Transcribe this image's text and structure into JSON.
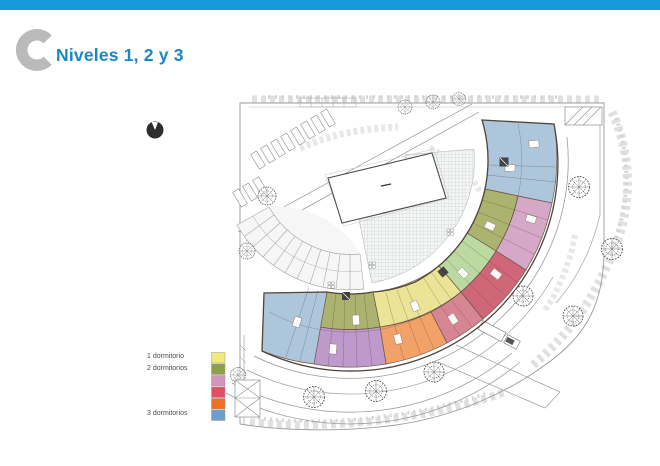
{
  "slide": {
    "bar_color": "#159bd9",
    "title": "Niveles 1, 2 y 3",
    "title_color": "#1b87c6",
    "logo_color": "#bababa"
  },
  "legend": {
    "labels": [
      "1 dormitorio",
      "2 dormitorios",
      "3 dormitorios"
    ],
    "swatch_colors": [
      "#f1ea79",
      "#8f9e4d",
      "#d295bb",
      "#e64c66",
      "#ee7123",
      "#6d9ed0"
    ]
  },
  "plan": {
    "unit_colors": {
      "blue": "#a9c3d9",
      "olive": "#a7af66",
      "pink": "#d2a3c3",
      "red": "#cd5f72",
      "red_light": "#d4808d",
      "orange": "#f19d60",
      "yellow": "#eae28f",
      "green": "#b7d79c",
      "purple": "#bb94c9"
    }
  }
}
